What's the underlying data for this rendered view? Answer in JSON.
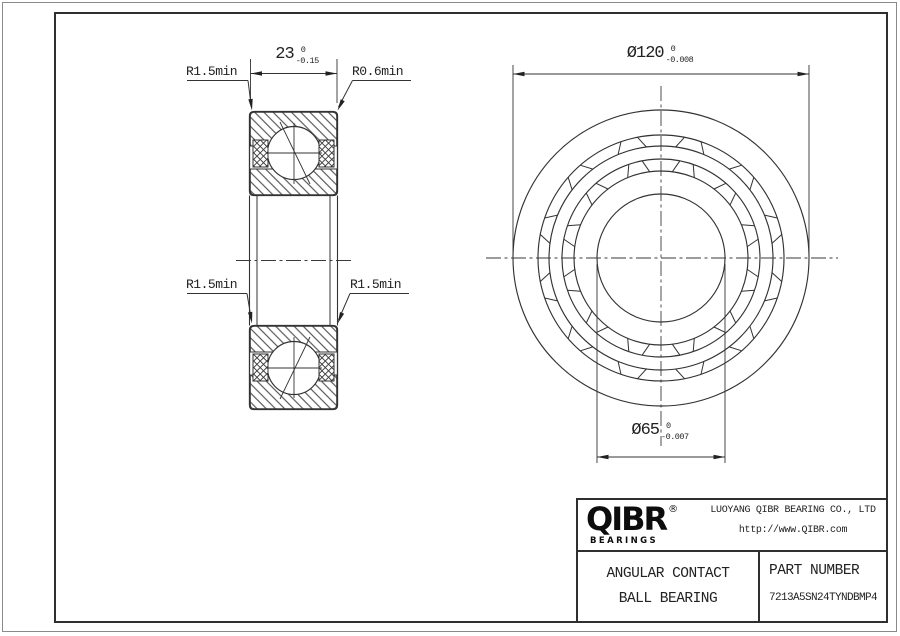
{
  "sheet": {
    "views": {
      "section": {
        "width_dim": {
          "nominal": "23",
          "tol_upper": "0",
          "tol_lower": "-0.15"
        },
        "callouts": {
          "top_left": "R1.5min",
          "top_right": "R0.6min",
          "mid_left": "R1.5min",
          "mid_right": "R1.5min"
        }
      },
      "front": {
        "outer_diameter_dim": {
          "nominal": "Ø120",
          "tol_upper": "0",
          "tol_lower": "-0.008"
        },
        "bore_diameter_dim": {
          "nominal": "Ø65",
          "tol_upper": "0",
          "tol_lower": "-0.007"
        }
      }
    },
    "title_block": {
      "brand": {
        "logo_text": "QIBR",
        "registered_mark": "®",
        "logo_subtext": "BEARINGS"
      },
      "company_name": "LUOYANG QIBR BEARING CO., LTD",
      "website": "http://www.QIBR.com",
      "product_type_line1": "ANGULAR CONTACT",
      "product_type_line2": "BALL BEARING",
      "part_number_label": "PART NUMBER",
      "part_number_value": "7213A5SN24TYNDBMP4"
    },
    "style": {
      "line_color": "#333333",
      "frame_color": "#2f2f2f",
      "background": "#ffffff"
    },
    "geometry": {
      "front_view": {
        "center": [
          661,
          258
        ],
        "ring_radii": [
          148,
          123,
          112,
          99,
          87,
          64
        ],
        "cage_pockets_per_band": 12,
        "pocket_bands": [
          [
            123,
            112
          ],
          [
            99,
            87
          ]
        ]
      }
    }
  }
}
